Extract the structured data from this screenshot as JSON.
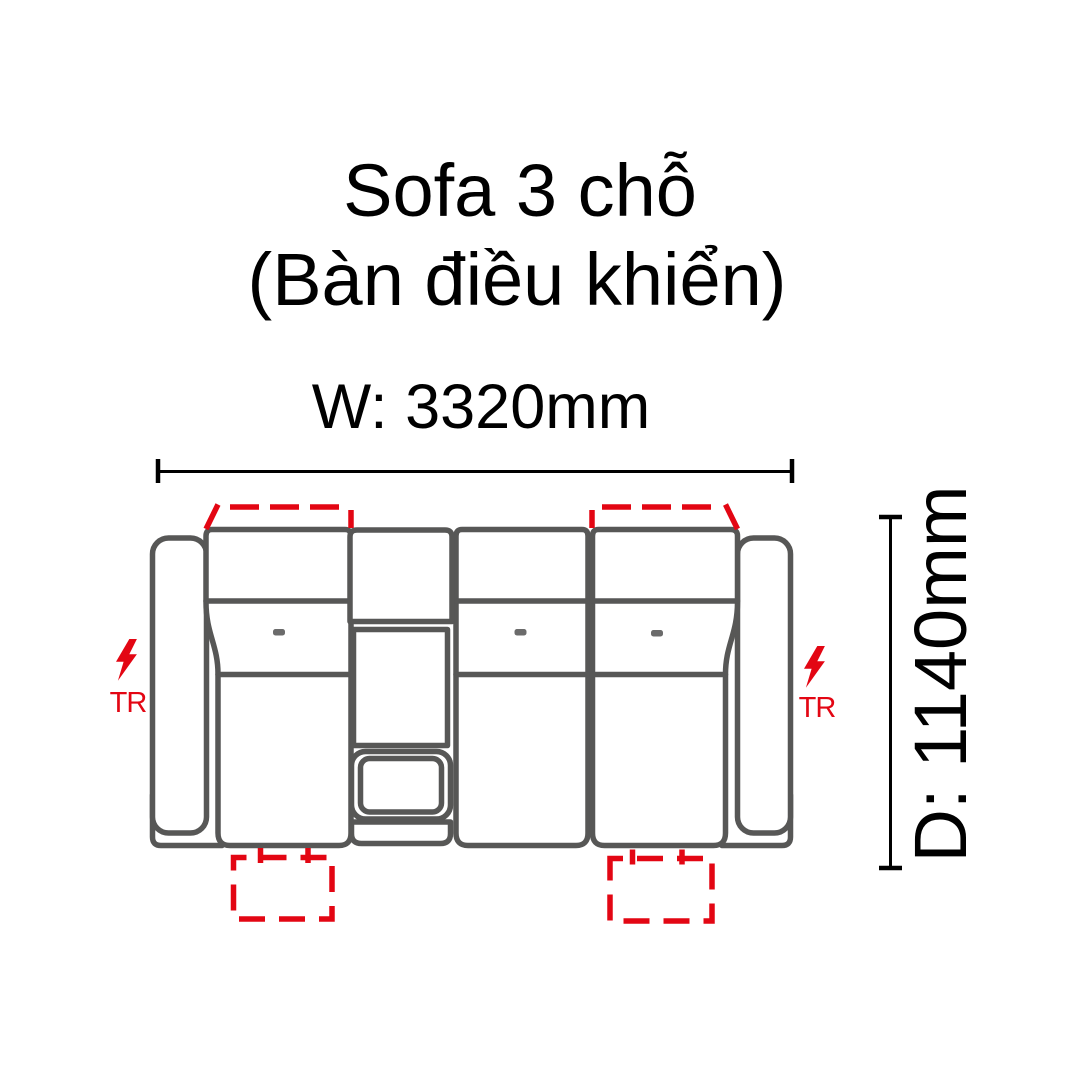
{
  "title": {
    "line1": "Sofa 3 chỗ",
    "line2": "(Bàn điều khiển)"
  },
  "dimensions": {
    "width_label": "W: 3320mm",
    "depth_label": "D: 1140mm"
  },
  "annotations": {
    "transformer_label": "TR",
    "power_icon": "lightning-bolt-icon",
    "headrest_motion": "red-dashed-trapezoid",
    "footrest_motion": "red-dashed-rectangle"
  },
  "diagram": {
    "type": "furniture-top-view",
    "subject": "3-seat recliner sofa with center control console",
    "seat_count": 3,
    "recliner_seats": [
      "left",
      "right"
    ],
    "console_features": [
      "back-pad",
      "body",
      "tray",
      "front-strip"
    ],
    "buttons_per_seat": 1
  },
  "colors": {
    "page_bg": "#ffffff",
    "outline_gray": "#575756",
    "button_gray": "#6b6b6b",
    "accent_red": "#e30613",
    "text_black": "#000000"
  }
}
